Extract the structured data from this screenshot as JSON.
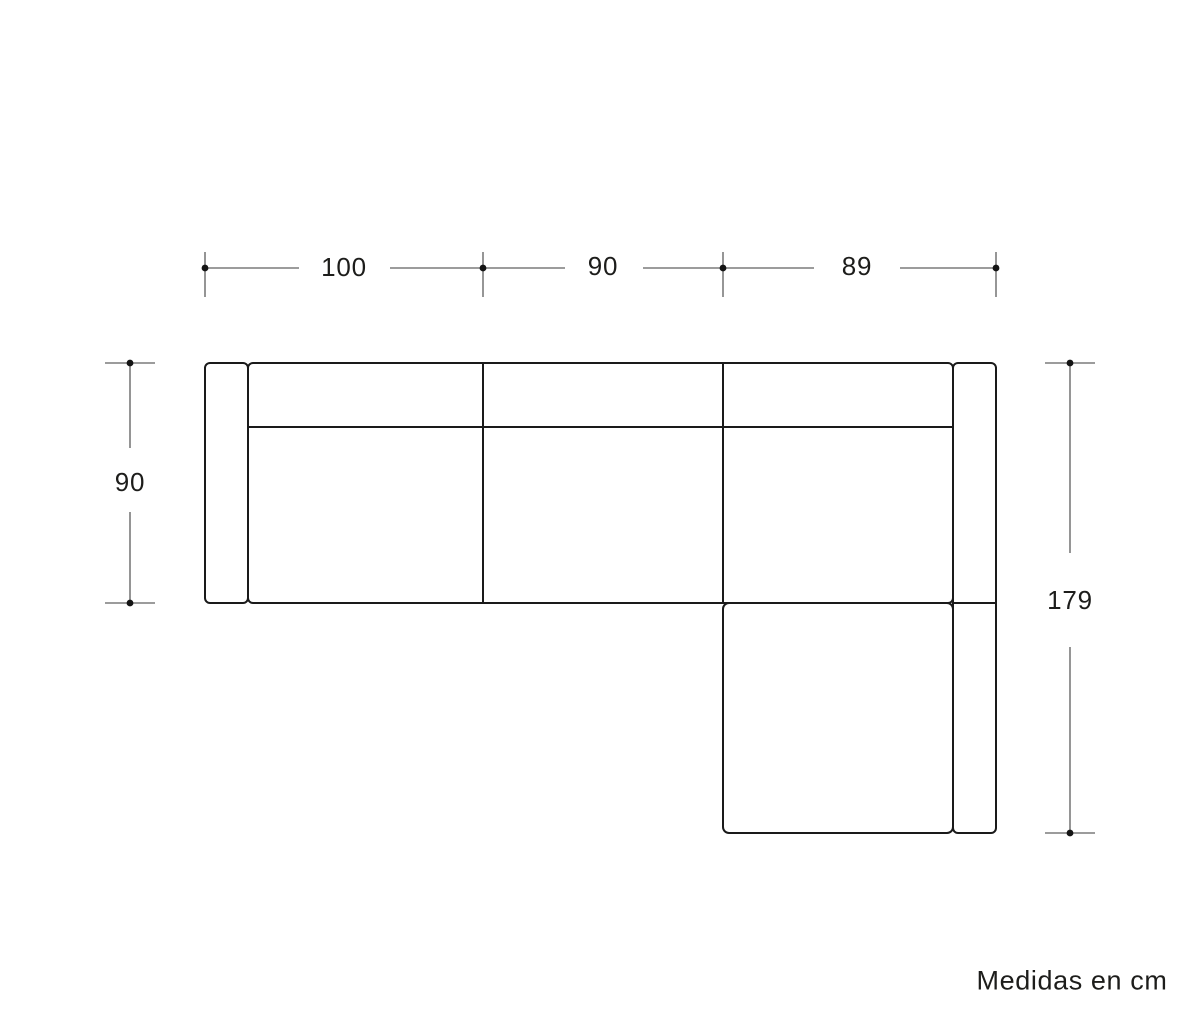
{
  "diagram": {
    "type": "sofa-top-view-dimension-drawing",
    "unit_note": "Medidas en cm",
    "colors": {
      "outline": "#1a1a1a",
      "dimension_line": "#7b7b7b",
      "dot": "#141414",
      "text": "#1d1d1b",
      "background": "#ffffff"
    },
    "dimensions": {
      "top": [
        {
          "label": "100",
          "value_cm": 100
        },
        {
          "label": "90",
          "value_cm": 90
        },
        {
          "label": "89",
          "value_cm": 89
        }
      ],
      "left": {
        "label": "90",
        "value_cm": 90
      },
      "right": {
        "label": "179",
        "value_cm": 179
      }
    }
  }
}
